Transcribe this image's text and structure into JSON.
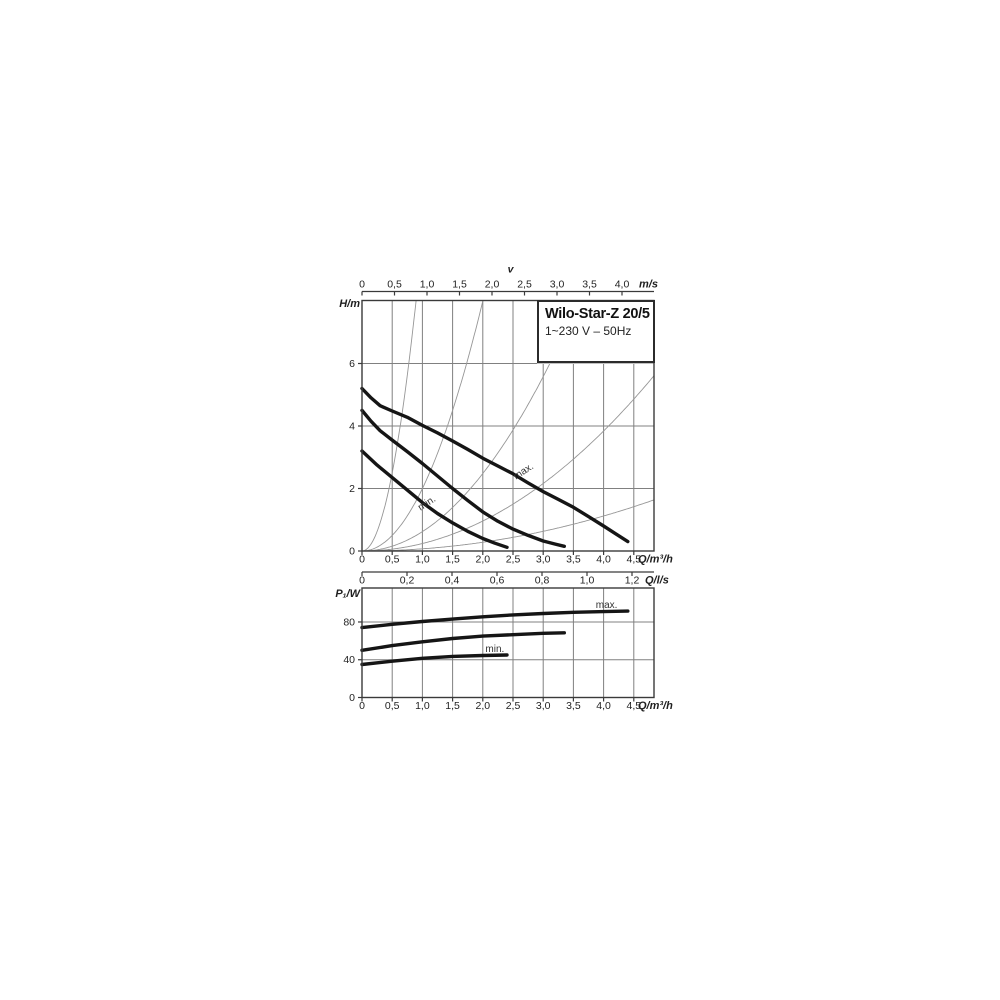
{
  "figure": {
    "description": "Pump performance curves, head and power input versus flow",
    "background": "#ffffff"
  },
  "colors": {
    "background": "#ffffff",
    "plot_border": "#3a3a3a",
    "gridline": "#808080",
    "guide_curve": "#969696",
    "pump_curve": "#151515",
    "text": "#1f1f1f",
    "annotation": "#333333",
    "title_box_border": "#2b2b2b"
  },
  "chart_data": [
    {
      "id": "head_flow",
      "type": "line",
      "title": "Wilo-Star-Z 20/5",
      "subtitle": "1~230 V – 50Hz",
      "x_axis": {
        "label": "Q/m³/h",
        "tick_values": [
          0,
          0.5,
          1,
          1.5,
          2,
          2.5,
          3,
          3.5,
          4,
          4.5
        ],
        "tick_labels": [
          "0",
          "0,5",
          "1,0",
          "1,5",
          "2,0",
          "2,5",
          "3,0",
          "3,5",
          "4,0",
          "4,5"
        ],
        "range": [
          0,
          4.83
        ]
      },
      "x_axis_secondary": {
        "label": "Q/l/s",
        "tick_values": [
          0,
          0.2,
          0.4,
          0.6,
          0.8,
          1.0,
          1.2
        ],
        "tick_labels": [
          "0",
          "0,2",
          "0,4",
          "0,6",
          "0,8",
          "1,0",
          "1,2"
        ]
      },
      "x_axis_top": {
        "title": "v",
        "unit": "m/s",
        "tick_values": [
          0,
          0.5,
          1,
          1.5,
          2,
          2.5,
          3,
          3.5,
          4
        ],
        "tick_labels": [
          "0",
          "0,5",
          "1,0",
          "1,5",
          "2,0",
          "2,5",
          "3,0",
          "3,5",
          "4,0"
        ]
      },
      "y_axis": {
        "label": "H/m",
        "tick_values": [
          0,
          2,
          4,
          6
        ],
        "tick_labels": [
          "0",
          "2",
          "4",
          "6"
        ],
        "gridlines": [
          2,
          4,
          6
        ],
        "range": [
          0,
          8.02
        ]
      },
      "velocity_guide_parabolas": {
        "formula": "H = k · Q²",
        "k_values": [
          10,
          2,
          0.62,
          0.24,
          0.07
        ]
      },
      "series": [
        {
          "name": "max",
          "points": [
            [
              0,
              5.2
            ],
            [
              0.15,
              4.9
            ],
            [
              0.3,
              4.65
            ],
            [
              0.5,
              4.48
            ],
            [
              0.75,
              4.28
            ],
            [
              1,
              4.02
            ],
            [
              1.25,
              3.78
            ],
            [
              1.5,
              3.52
            ],
            [
              1.75,
              3.25
            ],
            [
              2,
              2.97
            ],
            [
              2.25,
              2.72
            ],
            [
              2.5,
              2.47
            ],
            [
              2.75,
              2.18
            ],
            [
              3,
              1.9
            ],
            [
              3.25,
              1.65
            ],
            [
              3.5,
              1.4
            ],
            [
              3.75,
              1.1
            ],
            [
              4,
              0.8
            ],
            [
              4.2,
              0.55
            ],
            [
              4.4,
              0.3
            ]
          ]
        },
        {
          "name": "mid",
          "points": [
            [
              0,
              4.5
            ],
            [
              0.15,
              4.15
            ],
            [
              0.3,
              3.85
            ],
            [
              0.5,
              3.55
            ],
            [
              0.75,
              3.18
            ],
            [
              1,
              2.8
            ],
            [
              1.25,
              2.4
            ],
            [
              1.5,
              2.0
            ],
            [
              1.75,
              1.62
            ],
            [
              2,
              1.25
            ],
            [
              2.25,
              0.95
            ],
            [
              2.5,
              0.7
            ],
            [
              2.75,
              0.5
            ],
            [
              3,
              0.32
            ],
            [
              3.2,
              0.22
            ],
            [
              3.35,
              0.15
            ]
          ]
        },
        {
          "name": "min",
          "points": [
            [
              0,
              3.2
            ],
            [
              0.25,
              2.75
            ],
            [
              0.5,
              2.35
            ],
            [
              0.75,
              1.95
            ],
            [
              1,
              1.55
            ],
            [
              1.25,
              1.2
            ],
            [
              1.5,
              0.9
            ],
            [
              1.75,
              0.63
            ],
            [
              2,
              0.4
            ],
            [
              2.2,
              0.25
            ],
            [
              2.4,
              0.12
            ]
          ]
        }
      ],
      "annotations": [
        {
          "text": "max.",
          "q": 2.7,
          "y": 2.47,
          "angle": -33
        },
        {
          "text": "min.",
          "q": 1.1,
          "y": 1.45,
          "angle": -33
        }
      ]
    },
    {
      "id": "power_flow",
      "type": "line",
      "x_axis": {
        "label": "Q/m³/h",
        "tick_values": [
          0,
          0.5,
          1,
          1.5,
          2,
          2.5,
          3,
          3.5,
          4,
          4.5
        ],
        "tick_labels": [
          "0",
          "0,5",
          "1,0",
          "1,5",
          "2,0",
          "2,5",
          "3,0",
          "3,5",
          "4,0",
          "4,5"
        ],
        "range": [
          0,
          4.83
        ]
      },
      "y_axis": {
        "label": "P₁/W",
        "tick_values": [
          0,
          40,
          80
        ],
        "tick_labels": [
          "0",
          "40",
          "80"
        ],
        "gridlines": [
          40,
          80
        ],
        "range": [
          0,
          116
        ]
      },
      "series": [
        {
          "name": "max",
          "points": [
            [
              0,
              74
            ],
            [
              0.5,
              77.5
            ],
            [
              1,
              80.5
            ],
            [
              1.5,
              83
            ],
            [
              2,
              85.5
            ],
            [
              2.5,
              87.5
            ],
            [
              3,
              89
            ],
            [
              3.5,
              90.2
            ],
            [
              4,
              91
            ],
            [
              4.4,
              91.5
            ]
          ]
        },
        {
          "name": "mid",
          "points": [
            [
              0,
              50
            ],
            [
              0.5,
              55
            ],
            [
              1,
              59
            ],
            [
              1.5,
              62.5
            ],
            [
              2,
              65
            ],
            [
              2.5,
              66.5
            ],
            [
              3,
              68
            ],
            [
              3.35,
              68.5
            ]
          ]
        },
        {
          "name": "min",
          "points": [
            [
              0,
              35
            ],
            [
              0.5,
              38.5
            ],
            [
              1,
              41.5
            ],
            [
              1.5,
              43.5
            ],
            [
              2,
              44.5
            ],
            [
              2.4,
              45
            ]
          ]
        }
      ],
      "annotations": [
        {
          "text": "max.",
          "q": 4.05,
          "y": 95,
          "angle": 0
        },
        {
          "text": "min.",
          "q": 2.2,
          "y": 48,
          "angle": 0
        }
      ]
    }
  ]
}
